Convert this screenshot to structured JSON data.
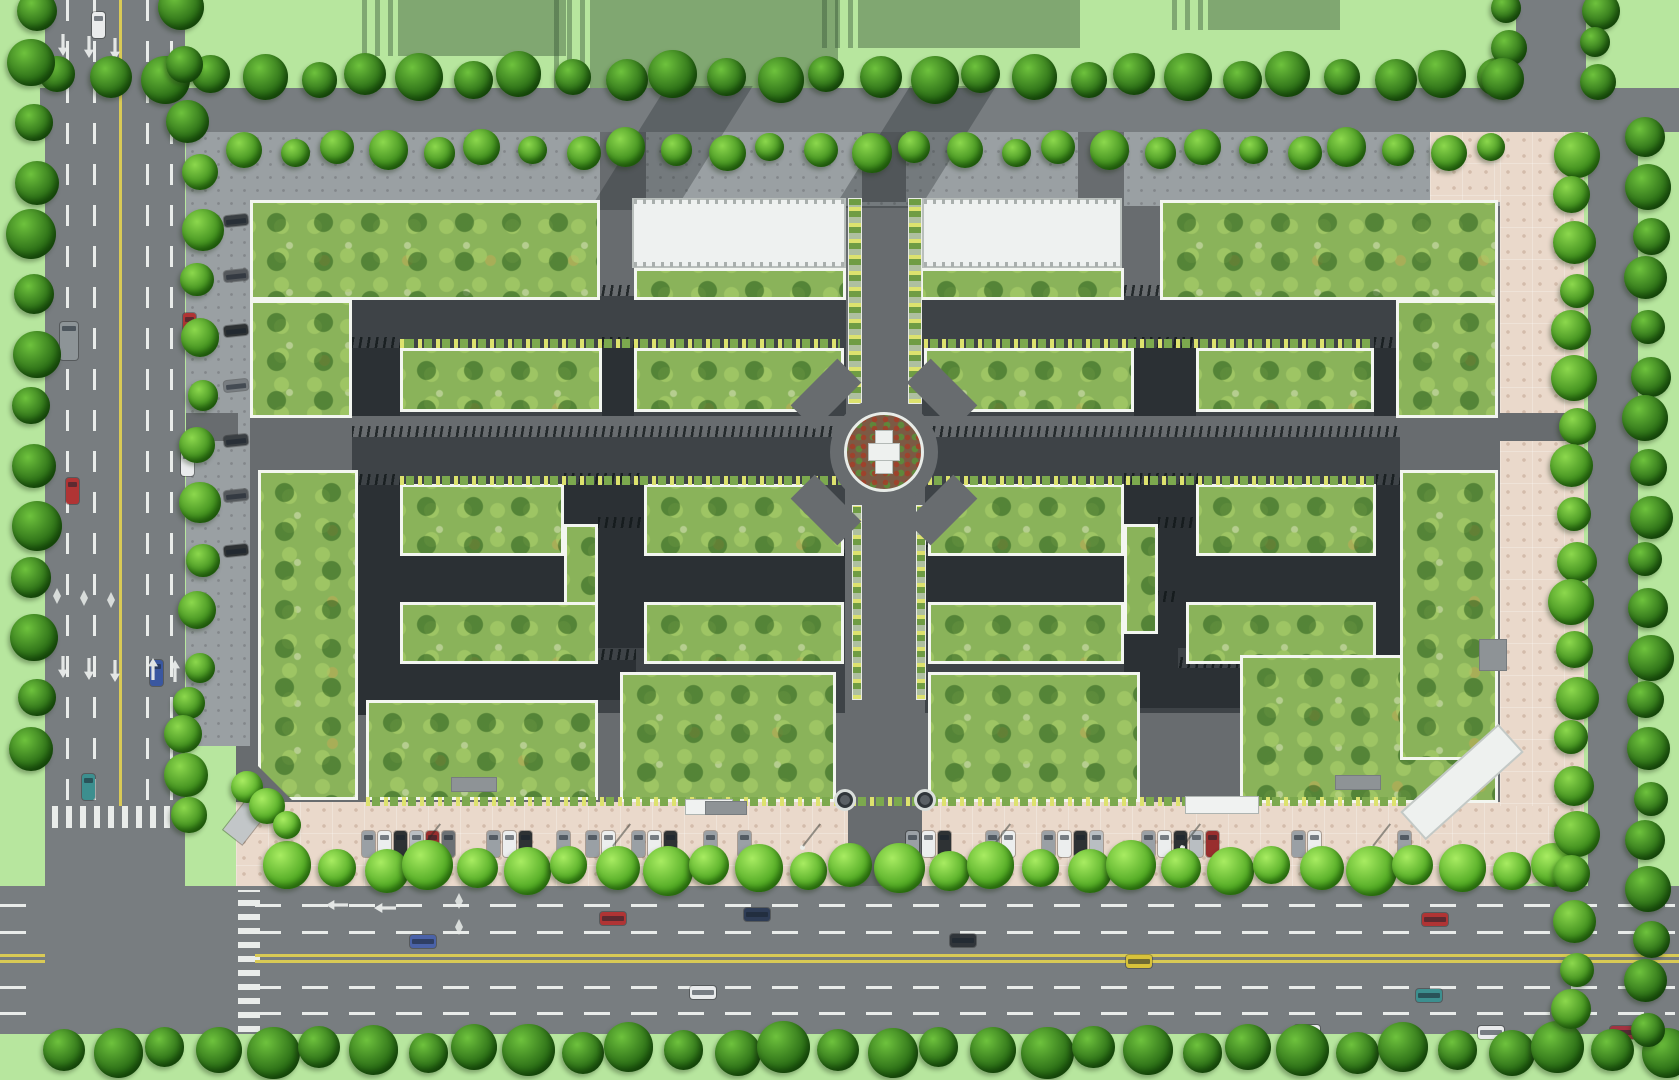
{
  "scene": {
    "w": 1679,
    "h": 1080,
    "kind": "aerial-site-plan-rendering"
  },
  "palette": {
    "grass": "#b7e69e",
    "road": "#787d80",
    "roadDark": "#686c6f",
    "pave": "#9aa0a3",
    "paveDot": "#82878a",
    "pink": "#ead9cb",
    "pinkDot": "#d3bcab",
    "dark": "#2b3034",
    "darkBase": "#3e4347",
    "court": "#8ab35a",
    "white": "#eef1f0",
    "yellow": "#d9ca55",
    "mark": "#e9ecea",
    "parked": [
      "#9aa0a5",
      "#eceeee",
      "#2e3234",
      "#b9bec2",
      "#992e2e",
      "#6b7074"
    ],
    "angled": [
      "#3a3f43",
      "#54585c",
      "#2e3234",
      "#787d81"
    ]
  },
  "layers": {
    "shadows": [
      [
        398,
        0,
        168,
        56
      ],
      [
        590,
        0,
        248,
        88
      ],
      [
        858,
        0,
        222,
        48
      ],
      [
        1208,
        0,
        132,
        30
      ]
    ],
    "roads": [
      [
        45,
        0,
        140,
        1034
      ],
      [
        40,
        88,
        1639,
        44
      ],
      [
        0,
        886,
        1679,
        148
      ],
      [
        1588,
        128,
        50,
        760
      ],
      [
        1516,
        0,
        70,
        92
      ]
    ],
    "lines": [
      {
        "x": 66,
        "y": 0,
        "w": 3,
        "h": 800,
        "t": "dashV"
      },
      {
        "x": 93,
        "y": 0,
        "w": 3,
        "h": 800,
        "t": "dashV"
      },
      {
        "x": 146,
        "y": 0,
        "w": 3,
        "h": 800,
        "t": "dashV"
      },
      {
        "x": 170,
        "y": 0,
        "w": 3,
        "h": 800,
        "t": "dashV"
      },
      {
        "x": 119,
        "y": 0,
        "w": 3,
        "h": 806,
        "t": "solidY"
      },
      {
        "x": 52,
        "y": 806,
        "w": 132,
        "h": 22,
        "t": "zebV"
      },
      {
        "x": 238,
        "y": 890,
        "w": 22,
        "h": 142,
        "t": "zebH"
      },
      {
        "x": 255,
        "y": 904,
        "w": 1420,
        "h": 3,
        "t": "dashH"
      },
      {
        "x": 255,
        "y": 931,
        "w": 1420,
        "h": 3,
        "t": "dashH"
      },
      {
        "x": 255,
        "y": 986,
        "w": 1420,
        "h": 3,
        "t": "dashH"
      },
      {
        "x": 255,
        "y": 1012,
        "w": 1420,
        "h": 3,
        "t": "dashH"
      },
      {
        "x": 0,
        "y": 904,
        "w": 45,
        "h": 3,
        "t": "dashH"
      },
      {
        "x": 0,
        "y": 931,
        "w": 45,
        "h": 3,
        "t": "dashH"
      },
      {
        "x": 0,
        "y": 986,
        "w": 45,
        "h": 3,
        "t": "dashH"
      },
      {
        "x": 0,
        "y": 1012,
        "w": 45,
        "h": 3,
        "t": "dashH"
      },
      {
        "x": 255,
        "y": 954,
        "w": 1424,
        "h": 3,
        "t": "solidY"
      },
      {
        "x": 255,
        "y": 960,
        "w": 1424,
        "h": 3,
        "t": "solidY"
      },
      {
        "x": 0,
        "y": 954,
        "w": 45,
        "h": 3,
        "t": "solidY"
      },
      {
        "x": 0,
        "y": 960,
        "w": 45,
        "h": 3,
        "t": "solidY"
      }
    ],
    "base": [
      [
        236,
        132,
        1266,
        712
      ]
    ],
    "pavements": [
      [
        186,
        132,
        1316,
        74
      ],
      [
        186,
        132,
        64,
        614
      ]
    ],
    "pinks": [
      [
        236,
        802,
        1348,
        84
      ],
      [
        1500,
        132,
        84,
        674
      ],
      [
        1430,
        132,
        70,
        70
      ]
    ],
    "conns": [
      [
        600,
        132,
        46,
        74
      ],
      [
        1078,
        132,
        46,
        74
      ],
      [
        862,
        132,
        44,
        70
      ],
      [
        848,
        690,
        74,
        196
      ],
      [
        186,
        413,
        52,
        28
      ],
      [
        1500,
        413,
        84,
        28
      ]
    ],
    "bands": [
      [
        628,
        86,
        86,
        124
      ],
      [
        872,
        86,
        86,
        122
      ]
    ],
    "darkBases": [
      [
        352,
        296,
        494,
        120
      ],
      [
        922,
        296,
        478,
        120
      ],
      [
        352,
        437,
        493,
        276
      ],
      [
        925,
        437,
        475,
        276
      ]
    ],
    "darkBars": [
      [
        352,
        348,
        48,
        68
      ],
      [
        602,
        348,
        32,
        68
      ],
      [
        1134,
        348,
        62,
        68
      ],
      [
        1374,
        348,
        26,
        68
      ],
      [
        352,
        485,
        48,
        230
      ],
      [
        1376,
        485,
        24,
        230
      ],
      [
        400,
        556,
        445,
        46
      ],
      [
        925,
        556,
        451,
        46
      ],
      [
        400,
        660,
        236,
        40
      ],
      [
        1124,
        668,
        116,
        40
      ],
      [
        564,
        484,
        80,
        44
      ],
      [
        598,
        528,
        46,
        120
      ],
      [
        1124,
        484,
        74,
        44
      ],
      [
        1158,
        528,
        40,
        120
      ],
      [
        1124,
        602,
        54,
        66
      ]
    ],
    "courtyards": [
      [
        250,
        200,
        350,
        100,
        ""
      ],
      [
        250,
        300,
        102,
        118,
        ""
      ],
      [
        634,
        268,
        212,
        32,
        ""
      ],
      [
        920,
        268,
        204,
        32,
        ""
      ],
      [
        1160,
        200,
        338,
        100,
        ""
      ],
      [
        1396,
        300,
        102,
        118,
        ""
      ],
      [
        400,
        348,
        202,
        64,
        ""
      ],
      [
        634,
        348,
        210,
        64,
        "br"
      ],
      [
        924,
        348,
        210,
        64,
        "bl"
      ],
      [
        1196,
        348,
        178,
        64,
        ""
      ],
      [
        258,
        470,
        100,
        330,
        "bl"
      ],
      [
        400,
        484,
        164,
        72,
        ""
      ],
      [
        564,
        524,
        34,
        110,
        ""
      ],
      [
        644,
        484,
        200,
        72,
        "tr"
      ],
      [
        400,
        602,
        198,
        62,
        ""
      ],
      [
        644,
        602,
        200,
        62,
        ""
      ],
      [
        366,
        700,
        232,
        100,
        ""
      ],
      [
        620,
        672,
        216,
        130,
        ""
      ],
      [
        928,
        484,
        196,
        72,
        "tl"
      ],
      [
        1124,
        524,
        34,
        110,
        ""
      ],
      [
        1196,
        484,
        180,
        72,
        ""
      ],
      [
        928,
        602,
        196,
        62,
        ""
      ],
      [
        1186,
        602,
        190,
        62,
        ""
      ],
      [
        928,
        672,
        212,
        130,
        ""
      ],
      [
        1240,
        655,
        258,
        148,
        ""
      ],
      [
        1400,
        470,
        98,
        290,
        "br"
      ]
    ],
    "palmRows": [
      [
        400,
        339,
        440,
        9
      ],
      [
        924,
        339,
        450,
        9
      ],
      [
        400,
        476,
        444,
        9
      ],
      [
        928,
        476,
        448,
        9
      ],
      [
        366,
        797,
        1040,
        9
      ]
    ],
    "palmWalks": [
      [
        848,
        198,
        14,
        206
      ],
      [
        908,
        198,
        14,
        206
      ],
      [
        852,
        505,
        10,
        195
      ],
      [
        916,
        505,
        10,
        195
      ]
    ],
    "whites": [
      [
        632,
        198,
        214,
        70
      ],
      [
        922,
        198,
        200,
        70
      ]
    ],
    "roundabout": {
      "cx": 884,
      "cy": 452,
      "rApron": 54,
      "rBed": 40,
      "stub": {
        "w": 66,
        "h": 34,
        "off": 58
      }
    },
    "fountains": [
      [
        845,
        800
      ],
      [
        925,
        800
      ]
    ],
    "kiosks": [
      {
        "x": 686,
        "y": 800,
        "w": 46,
        "h": 14,
        "k": "white"
      },
      {
        "x": 1186,
        "y": 797,
        "w": 72,
        "h": 16,
        "k": "white"
      },
      {
        "x": 452,
        "y": 778,
        "w": 44,
        "h": 13,
        "k": "gray"
      },
      {
        "x": 706,
        "y": 802,
        "w": 40,
        "h": 12,
        "k": "gray"
      },
      {
        "x": 1336,
        "y": 776,
        "w": 44,
        "h": 13,
        "k": "gray"
      },
      {
        "x": 1480,
        "y": 640,
        "w": 26,
        "h": 30,
        "k": "gray"
      }
    ],
    "diagBuilding": {
      "x": 1462,
      "y": 782,
      "w": 128,
      "h": 34,
      "rot": -42
    },
    "truck": {
      "x": 250,
      "y": 815,
      "rot": 38
    },
    "treeRows": [
      [
        60,
        77,
        1496,
        77,
        52,
        42,
        "dark"
      ],
      [
        244,
        150,
        1494,
        150,
        49,
        34,
        "mid"
      ],
      [
        34,
        8,
        34,
        752,
        56,
        44,
        "dark"
      ],
      [
        184,
        10,
        184,
        118,
        52,
        40,
        "dark"
      ],
      [
        200,
        172,
        200,
        668,
        55,
        36,
        "mid"
      ],
      [
        186,
        700,
        186,
        812,
        40,
        38,
        "mid"
      ],
      [
        290,
        868,
        1556,
        868,
        47,
        44,
        "bright"
      ],
      [
        64,
        1050,
        1664,
        1050,
        52,
        46,
        "dark"
      ],
      [
        1574,
        152,
        1574,
        1012,
        46,
        40,
        "mid"
      ],
      [
        1648,
        140,
        1648,
        1030,
        46,
        40,
        "dark"
      ],
      [
        1506,
        8,
        1506,
        82,
        38,
        36,
        "dark"
      ],
      [
        1598,
        8,
        1598,
        82,
        38,
        36,
        "dark"
      ],
      [
        250,
        790,
        284,
        822,
        24,
        34,
        "bright"
      ]
    ],
    "carsRoad": [
      {
        "x": 92,
        "y": 12,
        "o": "v",
        "c": "#e9ebec"
      },
      {
        "x": 60,
        "y": 322,
        "o": "v",
        "c": "#8d9497",
        "w": 18,
        "h": 38
      },
      {
        "x": 66,
        "y": 478,
        "o": "v",
        "c": "#b03434"
      },
      {
        "x": 181,
        "y": 450,
        "o": "v",
        "c": "#e9ebec"
      },
      {
        "x": 150,
        "y": 660,
        "o": "v",
        "c": "#3a57a0"
      },
      {
        "x": 82,
        "y": 774,
        "o": "v",
        "c": "#3c8f8f"
      },
      {
        "x": 180,
        "y": 766,
        "o": "v",
        "c": "#a33340"
      },
      {
        "x": 183,
        "y": 313,
        "o": "v",
        "c": "#b03434"
      },
      {
        "x": 600,
        "y": 912,
        "o": "h",
        "c": "#b03434"
      },
      {
        "x": 744,
        "y": 908,
        "o": "h",
        "c": "#2e3c55"
      },
      {
        "x": 410,
        "y": 935,
        "o": "h",
        "c": "#4a62a8"
      },
      {
        "x": 690,
        "y": 986,
        "o": "h",
        "c": "#e8eaeb"
      },
      {
        "x": 950,
        "y": 934,
        "o": "h",
        "c": "#30353a"
      },
      {
        "x": 1126,
        "y": 955,
        "o": "h",
        "c": "#d8c23a"
      },
      {
        "x": 1422,
        "y": 913,
        "o": "h",
        "c": "#b03434"
      },
      {
        "x": 1416,
        "y": 989,
        "o": "h",
        "c": "#3c8f8f"
      },
      {
        "x": 1294,
        "y": 1025,
        "o": "h",
        "c": "#e9ebec"
      },
      {
        "x": 1478,
        "y": 1026,
        "o": "h",
        "c": "#e9ebec"
      },
      {
        "x": 1610,
        "y": 1026,
        "o": "h",
        "c": "#a33340"
      }
    ],
    "parkedGroups": [
      {
        "x": 362,
        "y": 831,
        "n": 6,
        "sp": 16
      },
      {
        "x": 487,
        "y": 831,
        "n": 3,
        "sp": 16
      },
      {
        "x": 557,
        "y": 831,
        "n": 1,
        "sp": 16
      },
      {
        "x": 586,
        "y": 831,
        "n": 2,
        "sp": 16
      },
      {
        "x": 632,
        "y": 831,
        "n": 3,
        "sp": 16
      },
      {
        "x": 704,
        "y": 831,
        "n": 1,
        "sp": 16
      },
      {
        "x": 738,
        "y": 831,
        "n": 1,
        "sp": 16
      },
      {
        "x": 906,
        "y": 831,
        "n": 3,
        "sp": 16
      },
      {
        "x": 986,
        "y": 831,
        "n": 2,
        "sp": 16
      },
      {
        "x": 1042,
        "y": 831,
        "n": 4,
        "sp": 16
      },
      {
        "x": 1142,
        "y": 831,
        "n": 5,
        "sp": 16
      },
      {
        "x": 1292,
        "y": 831,
        "n": 2,
        "sp": 16
      },
      {
        "x": 1398,
        "y": 831,
        "n": 1,
        "sp": 16
      }
    ],
    "angledGroups": [
      {
        "x": 224,
        "y": 215,
        "n": 7,
        "sp": 55
      }
    ],
    "arrows": [
      {
        "x": 58,
        "y": 34,
        "d": "down"
      },
      {
        "x": 84,
        "y": 36,
        "d": "down"
      },
      {
        "x": 110,
        "y": 38,
        "d": "down"
      },
      {
        "x": 58,
        "y": 656,
        "d": "down"
      },
      {
        "x": 84,
        "y": 658,
        "d": "down"
      },
      {
        "x": 110,
        "y": 660,
        "d": "down"
      },
      {
        "x": 148,
        "y": 658,
        "d": "up"
      },
      {
        "x": 170,
        "y": 660,
        "d": "up"
      },
      {
        "x": 332,
        "y": 894,
        "d": "left"
      },
      {
        "x": 380,
        "y": 897,
        "d": "left"
      }
    ],
    "diamonds": [
      [
        53,
        588
      ],
      [
        80,
        590
      ],
      [
        107,
        592
      ],
      [
        455,
        893
      ],
      [
        455,
        919
      ]
    ],
    "lamps": [
      [
        420,
        845
      ],
      [
        610,
        845
      ],
      [
        800,
        845
      ],
      [
        990,
        845
      ],
      [
        1180,
        845
      ],
      [
        1370,
        845
      ]
    ]
  }
}
